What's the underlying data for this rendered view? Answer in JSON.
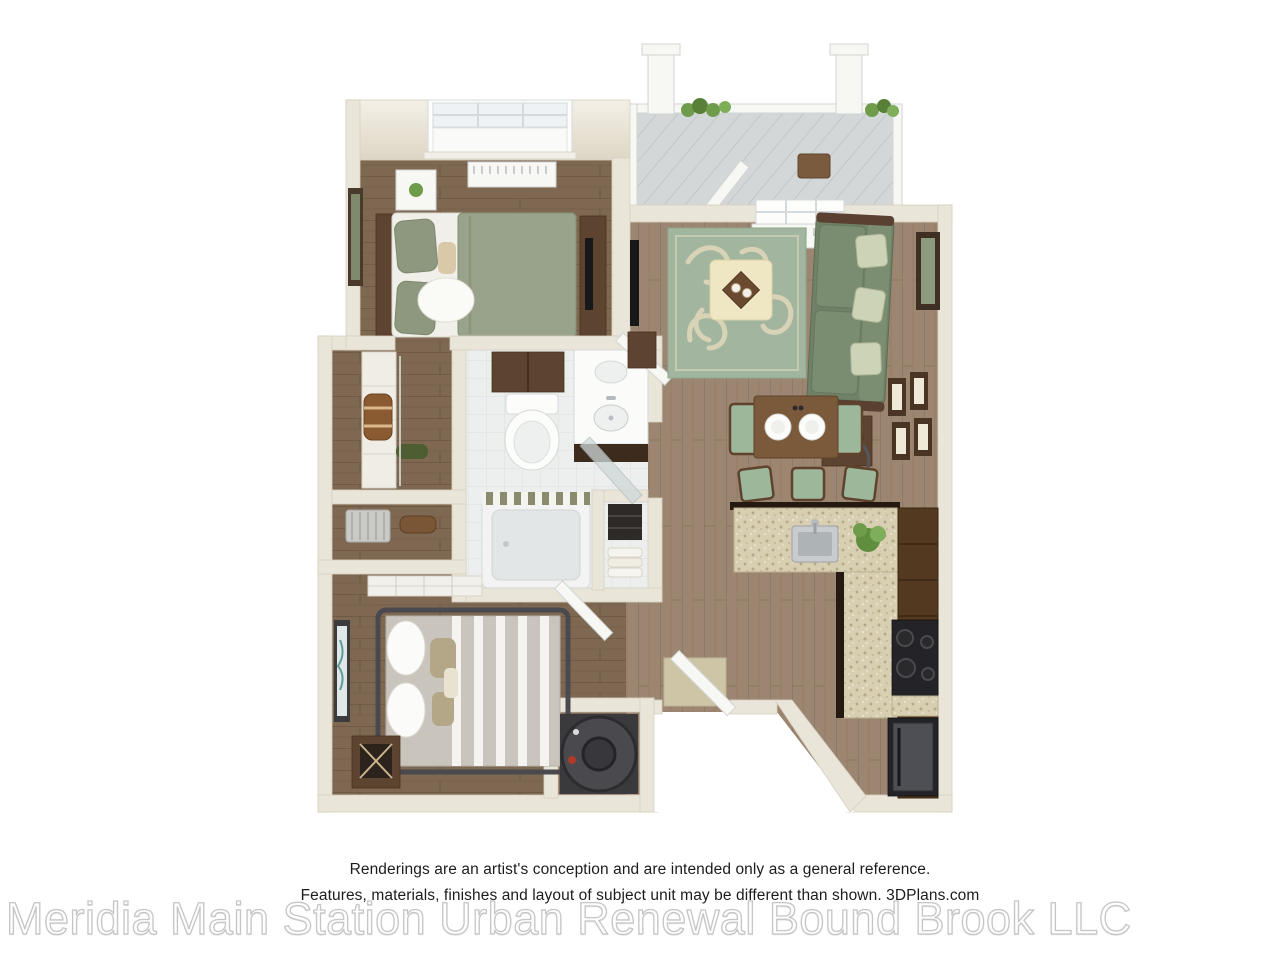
{
  "page": {
    "background": "#ffffff",
    "description_semantic": "3D rendered one-bedroom-style apartment floor plan"
  },
  "disclaimer": {
    "line1": "Renderings are an artist's conception and are intended only as a general reference.",
    "line2": "Features, materials, finishes and layout of subject unit may be different than shown. 3DPlans.com"
  },
  "watermark": {
    "text": "Meridia Main Station Urban Renewal Bound Brook LLC",
    "fill": "#fefefe",
    "outline": "#c6c6c6"
  },
  "colors": {
    "wall": "#eae5d9",
    "wall_shadow": "#d7d0c0",
    "bedroom_floor": "#7e6852",
    "living_floor": "#9c8671",
    "bath_tile": "#ecefee",
    "balcony_deck": "#d4d7d8",
    "rug_green": "#a2b59e",
    "rug_pattern": "#d8d3b6",
    "sofa_green": "#6f8166",
    "bed1_duvet": "#99a28a",
    "bed2_duvet": "#c9c5bc",
    "ottoman_cream": "#efe6c4",
    "wood_furniture": "#5d4430",
    "granite_counter": "#d8cfb2",
    "appliance_black": "#242327",
    "seat_green": "#9db79b",
    "plant_green": "#6f9c4a"
  }
}
